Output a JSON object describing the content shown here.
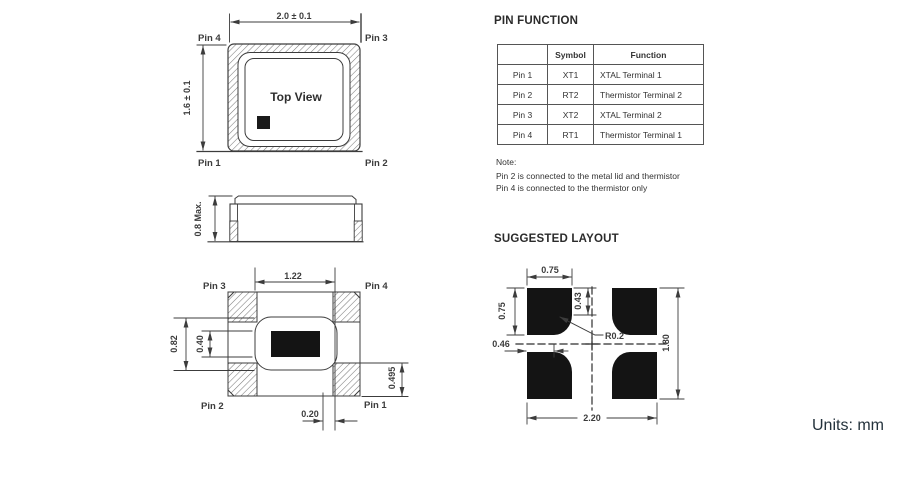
{
  "units_label": "Units: mm",
  "top_view": {
    "title": "Top View",
    "dim_width": "2.0 ± 0.1",
    "dim_height": "1.6 ± 0.1",
    "pin_top_left": "Pin 4",
    "pin_top_right": "Pin 3",
    "pin_bottom_left": "Pin 1",
    "pin_bottom_right": "Pin 2"
  },
  "side_view": {
    "dim_height": "0.8 Max."
  },
  "bottom_view": {
    "pin_top_left": "Pin 3",
    "pin_top_right": "Pin 4",
    "pin_bottom_left": "Pin 2",
    "pin_bottom_right": "Pin 1",
    "dim_pad_span": "1.22",
    "dim_outer_height": "0.82",
    "dim_inner_height": "0.40",
    "dim_pad_height": "0.495",
    "dim_offset": "0.20"
  },
  "pin_function": {
    "title": "PIN FUNCTION",
    "headers": [
      "",
      "Symbol",
      "Function"
    ],
    "rows": [
      [
        "Pin 1",
        "XT1",
        "XTAL Terminal 1"
      ],
      [
        "Pin 2",
        "RT2",
        "Thermistor Terminal 2"
      ],
      [
        "Pin 3",
        "XT2",
        "XTAL Terminal 2"
      ],
      [
        "Pin 4",
        "RT1",
        "Thermistor Terminal 1"
      ]
    ],
    "note_label": "Note:",
    "notes": [
      "Pin 2 is connected to the metal lid and thermistor",
      "Pin 4 is connected to the thermistor only"
    ]
  },
  "suggested_layout": {
    "title": "SUGGESTED LAYOUT",
    "dim_pad_width": "0.75",
    "dim_pad_height": "0.75",
    "dim_notch_v": "0.43",
    "dim_notch_h": "0.46",
    "dim_total_width": "2.20",
    "dim_total_height": "1.80",
    "dim_radius": "R0.2"
  }
}
